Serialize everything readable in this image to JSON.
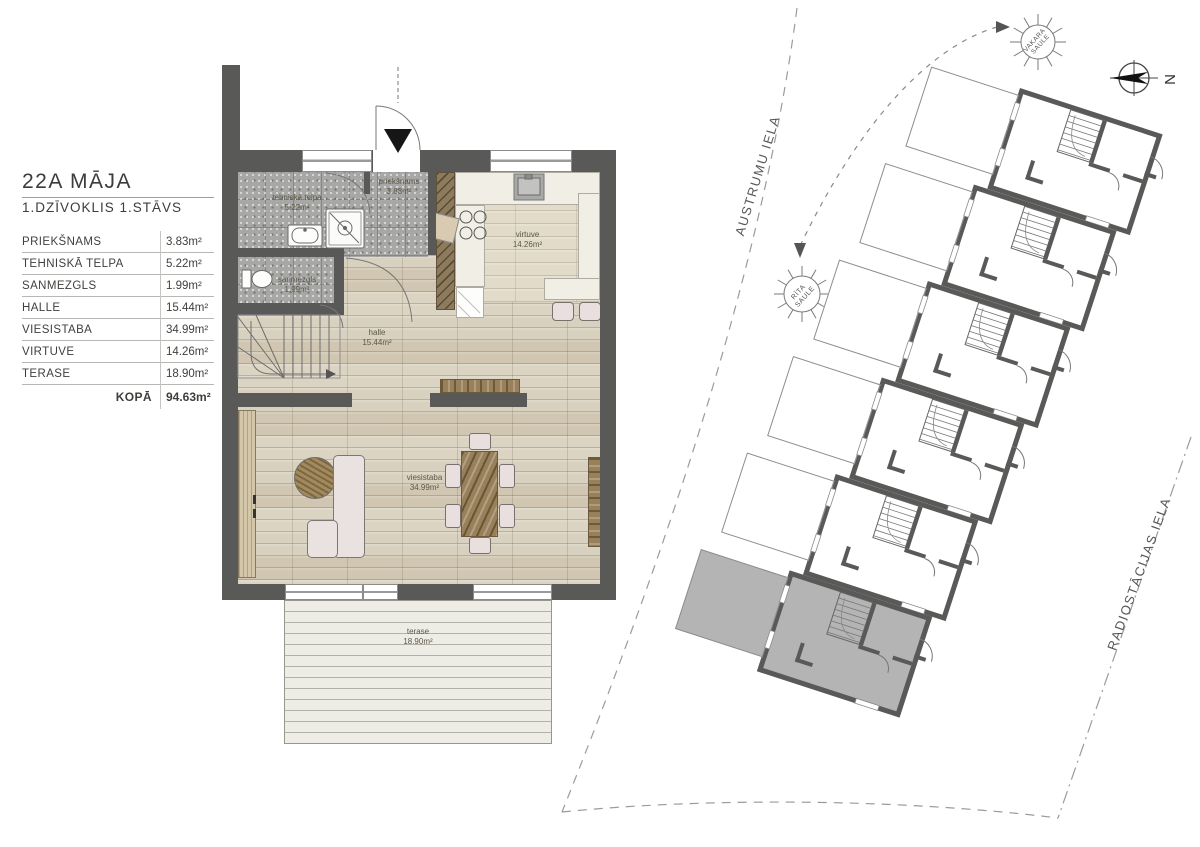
{
  "legend": {
    "title": "22A MĀJA",
    "subtitle": "1.DZĪVOKLIS 1.STĀVS",
    "rows": [
      {
        "name": "PRIEKŠNAMS",
        "area": "3.83m²"
      },
      {
        "name": "TEHNISKĀ TELPA",
        "area": "5.22m²"
      },
      {
        "name": "SANMEZGLS",
        "area": "1.99m²"
      },
      {
        "name": "HALLE",
        "area": "15.44m²"
      },
      {
        "name": "VIESISTABA",
        "area": "34.99m²"
      },
      {
        "name": "VIRTUVE",
        "area": "14.26m²"
      },
      {
        "name": "TERASE",
        "area": "18.90m²"
      }
    ],
    "total": {
      "label": "KOPĀ",
      "area": "94.63m²"
    }
  },
  "floor_plan": {
    "rooms": [
      {
        "name": "priekšnams",
        "area": "3.83m²"
      },
      {
        "name": "tehniskā telpa",
        "area": "5.22m²"
      },
      {
        "name": "sanmezgls",
        "area": "1.99m²"
      },
      {
        "name": "halle",
        "area": "15.44m²"
      },
      {
        "name": "viesistaba",
        "area": "34.99m²"
      },
      {
        "name": "virtuve",
        "area": "14.26m²"
      },
      {
        "name": "terase",
        "area": "18.90m²"
      }
    ]
  },
  "site_plan": {
    "streets": [
      {
        "name": "AUSTRUMU IELA"
      },
      {
        "name": "RADIOSTĀCIJAS IELA"
      }
    ],
    "suns": [
      {
        "line1": "VAKARA",
        "line2": "SAULE"
      },
      {
        "line1": "RĪTA",
        "line2": "SAULE"
      }
    ],
    "north_label": "N",
    "units": [
      {
        "highlighted": false
      },
      {
        "highlighted": false
      },
      {
        "highlighted": false
      },
      {
        "highlighted": false
      },
      {
        "highlighted": false
      },
      {
        "highlighted": true
      }
    ]
  },
  "colors": {
    "wall": "#595958",
    "tile_floor": "#a7a7a6",
    "wood_floor": "#d6cdba",
    "highlight_unit": "#b4b4b4",
    "terrace_deck": "#edece5"
  }
}
